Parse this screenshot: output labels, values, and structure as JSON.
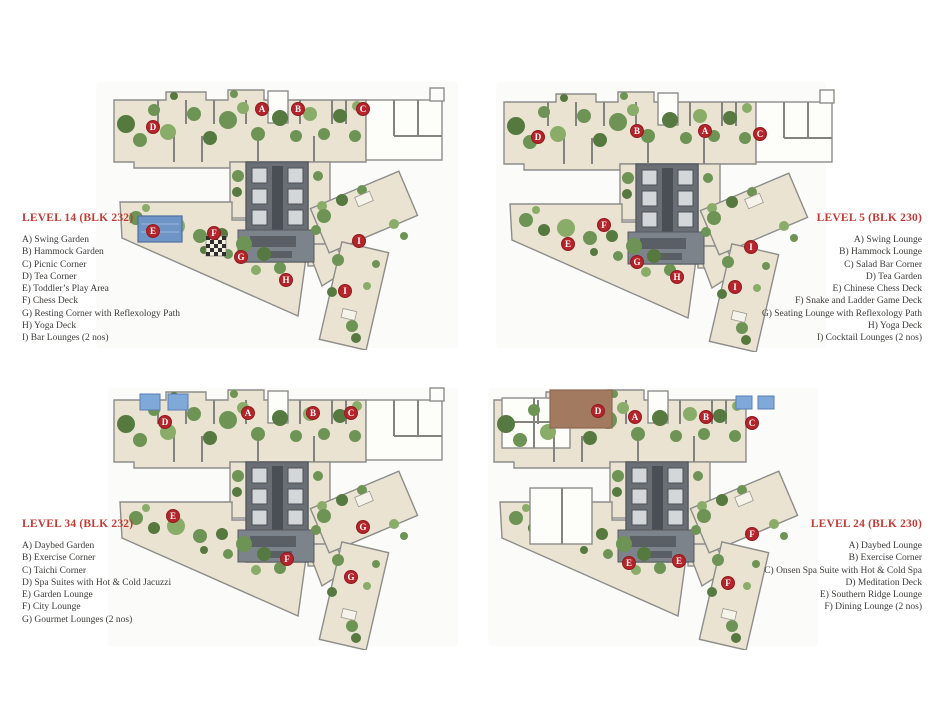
{
  "colors": {
    "marker_red": "#b5242a",
    "title_red": "#c23a34",
    "body_text": "#3d3b38",
    "floor_beige": "#eae3d1",
    "wall_gray": "#8d8d8a",
    "core_gray": "#6a6f76",
    "green": "#6d9355",
    "green_dark": "#55793f",
    "green_light": "#8aac69",
    "pool_blue": "#6f94c6",
    "jacuzzi_blue": "#7fa9d8",
    "deck_brown": "#a27a5f"
  },
  "plans": [
    {
      "legend": {
        "title": "LEVEL 14 (BLK 232)",
        "align": "left",
        "items": [
          "A) Swing Garden",
          "B) Hammock Garden",
          "C) Picnic Corner",
          "D) Tea Corner",
          "E) Toddler’s Play Area",
          "F) Chess Deck",
          "G) Resting Corner with Reflexology Path",
          "H) Yoga Deck",
          "I)  Bar Lounges (2 nos)"
        ]
      },
      "features": {
        "pool": true,
        "chess": true,
        "annex": "right"
      },
      "markers": [
        {
          "label": "A",
          "x": 152,
          "y": 31
        },
        {
          "label": "B",
          "x": 188,
          "y": 31
        },
        {
          "label": "C",
          "x": 253,
          "y": 31
        },
        {
          "label": "D",
          "x": 43,
          "y": 49
        },
        {
          "label": "E",
          "x": 43,
          "y": 153
        },
        {
          "label": "F",
          "x": 104,
          "y": 155
        },
        {
          "label": "G",
          "x": 131,
          "y": 179
        },
        {
          "label": "H",
          "x": 176,
          "y": 202
        },
        {
          "label": "I",
          "x": 249,
          "y": 163
        },
        {
          "label": "I",
          "x": 235,
          "y": 213
        }
      ]
    },
    {
      "legend": {
        "title": "LEVEL 5 (BLK 230)",
        "align": "right",
        "items": [
          "A) Swing Lounge",
          "B) Hammock Lounge",
          "C) Salad Bar Corner",
          "D) Tea Garden",
          "E) Chinese Chess Deck",
          "F) Snake and Ladder Game Deck",
          "G) Seating Lounge with Reflexology Path",
          "H) Yoga Deck",
          "I) Cocktail Lounges (2 nos)"
        ]
      },
      "features": {
        "annex": "right"
      },
      "markers": [
        {
          "label": "B",
          "x": 137,
          "y": 51
        },
        {
          "label": "A",
          "x": 205,
          "y": 51
        },
        {
          "label": "C",
          "x": 260,
          "y": 54
        },
        {
          "label": "D",
          "x": 38,
          "y": 57
        },
        {
          "label": "E",
          "x": 68,
          "y": 164
        },
        {
          "label": "F",
          "x": 104,
          "y": 145
        },
        {
          "label": "G",
          "x": 137,
          "y": 182
        },
        {
          "label": "H",
          "x": 177,
          "y": 197
        },
        {
          "label": "I",
          "x": 251,
          "y": 167
        },
        {
          "label": "I",
          "x": 235,
          "y": 207
        }
      ]
    },
    {
      "legend": {
        "title": "LEVEL 34 (BLK 232)",
        "align": "left",
        "items": [
          "A) Daybed Garden",
          "B) Exercise Corner",
          "C) Taichi Corner",
          "D) Spa Suites with Hot & Cold Jacuzzi",
          "E)  Garden Lounge",
          "F)  City Lounge",
          "G) Gourmet Lounges (2 nos)"
        ]
      },
      "features": {
        "jacuzzi": true,
        "annex": "right"
      },
      "markers": [
        {
          "label": "A",
          "x": 138,
          "y": 35
        },
        {
          "label": "B",
          "x": 203,
          "y": 35
        },
        {
          "label": "C",
          "x": 241,
          "y": 35
        },
        {
          "label": "D",
          "x": 55,
          "y": 44
        },
        {
          "label": "E",
          "x": 63,
          "y": 138
        },
        {
          "label": "F",
          "x": 177,
          "y": 181
        },
        {
          "label": "G",
          "x": 253,
          "y": 149
        },
        {
          "label": "G",
          "x": 241,
          "y": 199
        }
      ]
    },
    {
      "legend": {
        "title": "LEVEL 24 (BLK 230)",
        "align": "right",
        "items": [
          "A) Daybed Lounge",
          "B) Exercise Corner",
          "C) Onsen Spa Suite with Hot & Cold Spa",
          "D) Meditation Deck",
          "E) Southern Ridge Lounge",
          "F) Dining Lounge (2 nos)"
        ]
      },
      "features": {
        "deck": true,
        "jacuzziRight": true,
        "rooms": true,
        "annex": "left"
      },
      "markers": [
        {
          "label": "D",
          "x": 108,
          "y": 33
        },
        {
          "label": "A",
          "x": 145,
          "y": 39
        },
        {
          "label": "B",
          "x": 216,
          "y": 39
        },
        {
          "label": "C",
          "x": 262,
          "y": 45
        },
        {
          "label": "E",
          "x": 139,
          "y": 185
        },
        {
          "label": "E",
          "x": 189,
          "y": 183
        },
        {
          "label": "F",
          "x": 262,
          "y": 156
        },
        {
          "label": "F",
          "x": 238,
          "y": 205
        }
      ]
    }
  ]
}
